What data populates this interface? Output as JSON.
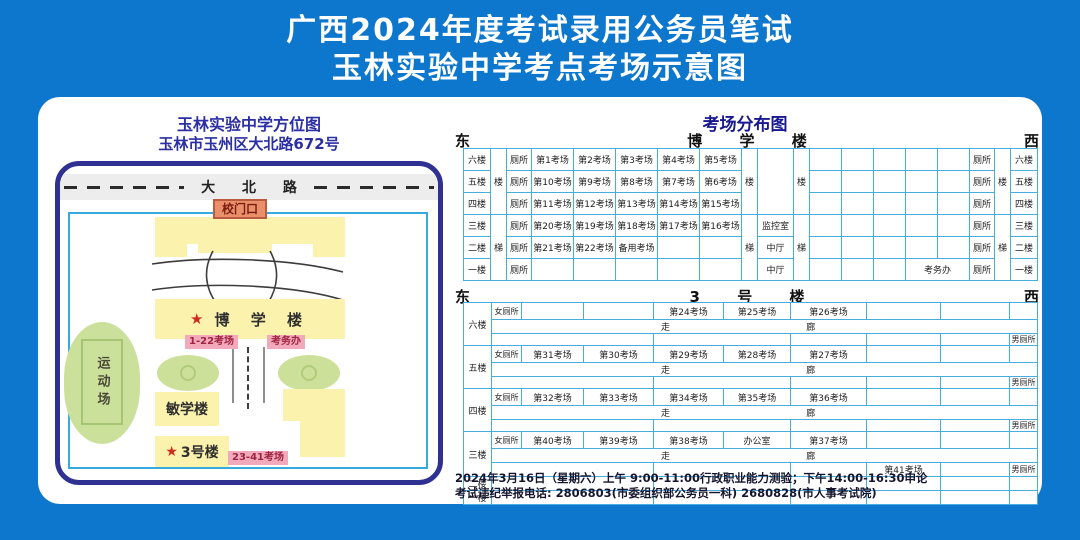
{
  "title": {
    "line1": "广西2024年度考试录用公务员笔试",
    "line2": "玉林实验中学考点考场示意图"
  },
  "map": {
    "title": "玉林实验中学方位图",
    "subtitle": "玉林市玉州区大北路672号",
    "road_name": "大 北 路",
    "gate_label": "校门口",
    "star": "★",
    "boxue_label": "博 学 楼",
    "boxue_rooms_tag": "1-22考场",
    "kaowuban_tag": "考务办",
    "sports_label": "运动场",
    "minxue_label": "敏学楼",
    "bldg3_label": "3号楼",
    "bldg3_rooms_tag": "23-41考场"
  },
  "dist": {
    "title": "考场分布图",
    "east": "东",
    "west": "西",
    "boxue_header": "博 学 楼",
    "b3_header": "3 号 楼",
    "boxue": {
      "floors": [
        "六楼",
        "五楼",
        "四楼",
        "三楼",
        "二楼",
        "一楼"
      ],
      "stair_upper": "楼",
      "stair_lower": "梯",
      "wc": "厕所",
      "rooms": [
        [
          "第1考场",
          "第2考场",
          "第3考场",
          "第4考场",
          "第5考场"
        ],
        [
          "第10考场",
          "第9考场",
          "第8考场",
          "第7考场",
          "第6考场"
        ],
        [
          "第11考场",
          "第12考场",
          "第13考场",
          "第14考场",
          "第15考场"
        ],
        [
          "第20考场",
          "第19考场",
          "第18考场",
          "第17考场",
          "第16考场"
        ],
        [
          "第21考场",
          "第22考场",
          "备用考场",
          "",
          ""
        ],
        [
          "",
          "",
          "",
          "",
          ""
        ]
      ],
      "hall": [
        "",
        "",
        "",
        "监控室",
        "中厅",
        "中厅"
      ],
      "kaowuban": "考务办"
    },
    "b3": {
      "floors": [
        "六楼",
        "五楼",
        "四楼",
        "三楼"
      ],
      "floors_thin": [
        "二楼",
        "一楼"
      ],
      "women_wc": "女厕所",
      "men_wc": "男厕所",
      "corridor_left": "走",
      "corridor_right": "廊",
      "rooms": [
        [
          "",
          "",
          "第24考场",
          "第25考场",
          "第26考场",
          "",
          "",
          ""
        ],
        [
          "第31考场",
          "第30考场",
          "第29考场",
          "第28考场",
          "第27考场",
          "",
          "",
          ""
        ],
        [
          "第32考场",
          "第33考场",
          "第34考场",
          "第35考场",
          "第36考场",
          "",
          "",
          ""
        ],
        [
          "第40考场",
          "第39考场",
          "第38考场",
          "办公室",
          "第37考场",
          "",
          "",
          ""
        ]
      ],
      "room41": "第41考场"
    }
  },
  "footer": {
    "line1": "2024年3月16日（星期六）上午 9:00-11:00行政职业能力测验；下午14:00-16:30申论",
    "line2": "考试违纪举报电话: 2806803(市委组织部公务员一科)  2680828(市人事考试院)"
  },
  "colors": {
    "background_blue": "#0d76cd",
    "map_border_navy": "#2e3192",
    "table_border_blue": "#46aede",
    "building_yellow": "#faf2ad",
    "lawn_green": "#cde09a",
    "tag_pink": "#f3a9bc",
    "gate_orange": "#e9906a",
    "title_blue": "#2b2fa3",
    "star_red": "#cf2b20"
  }
}
